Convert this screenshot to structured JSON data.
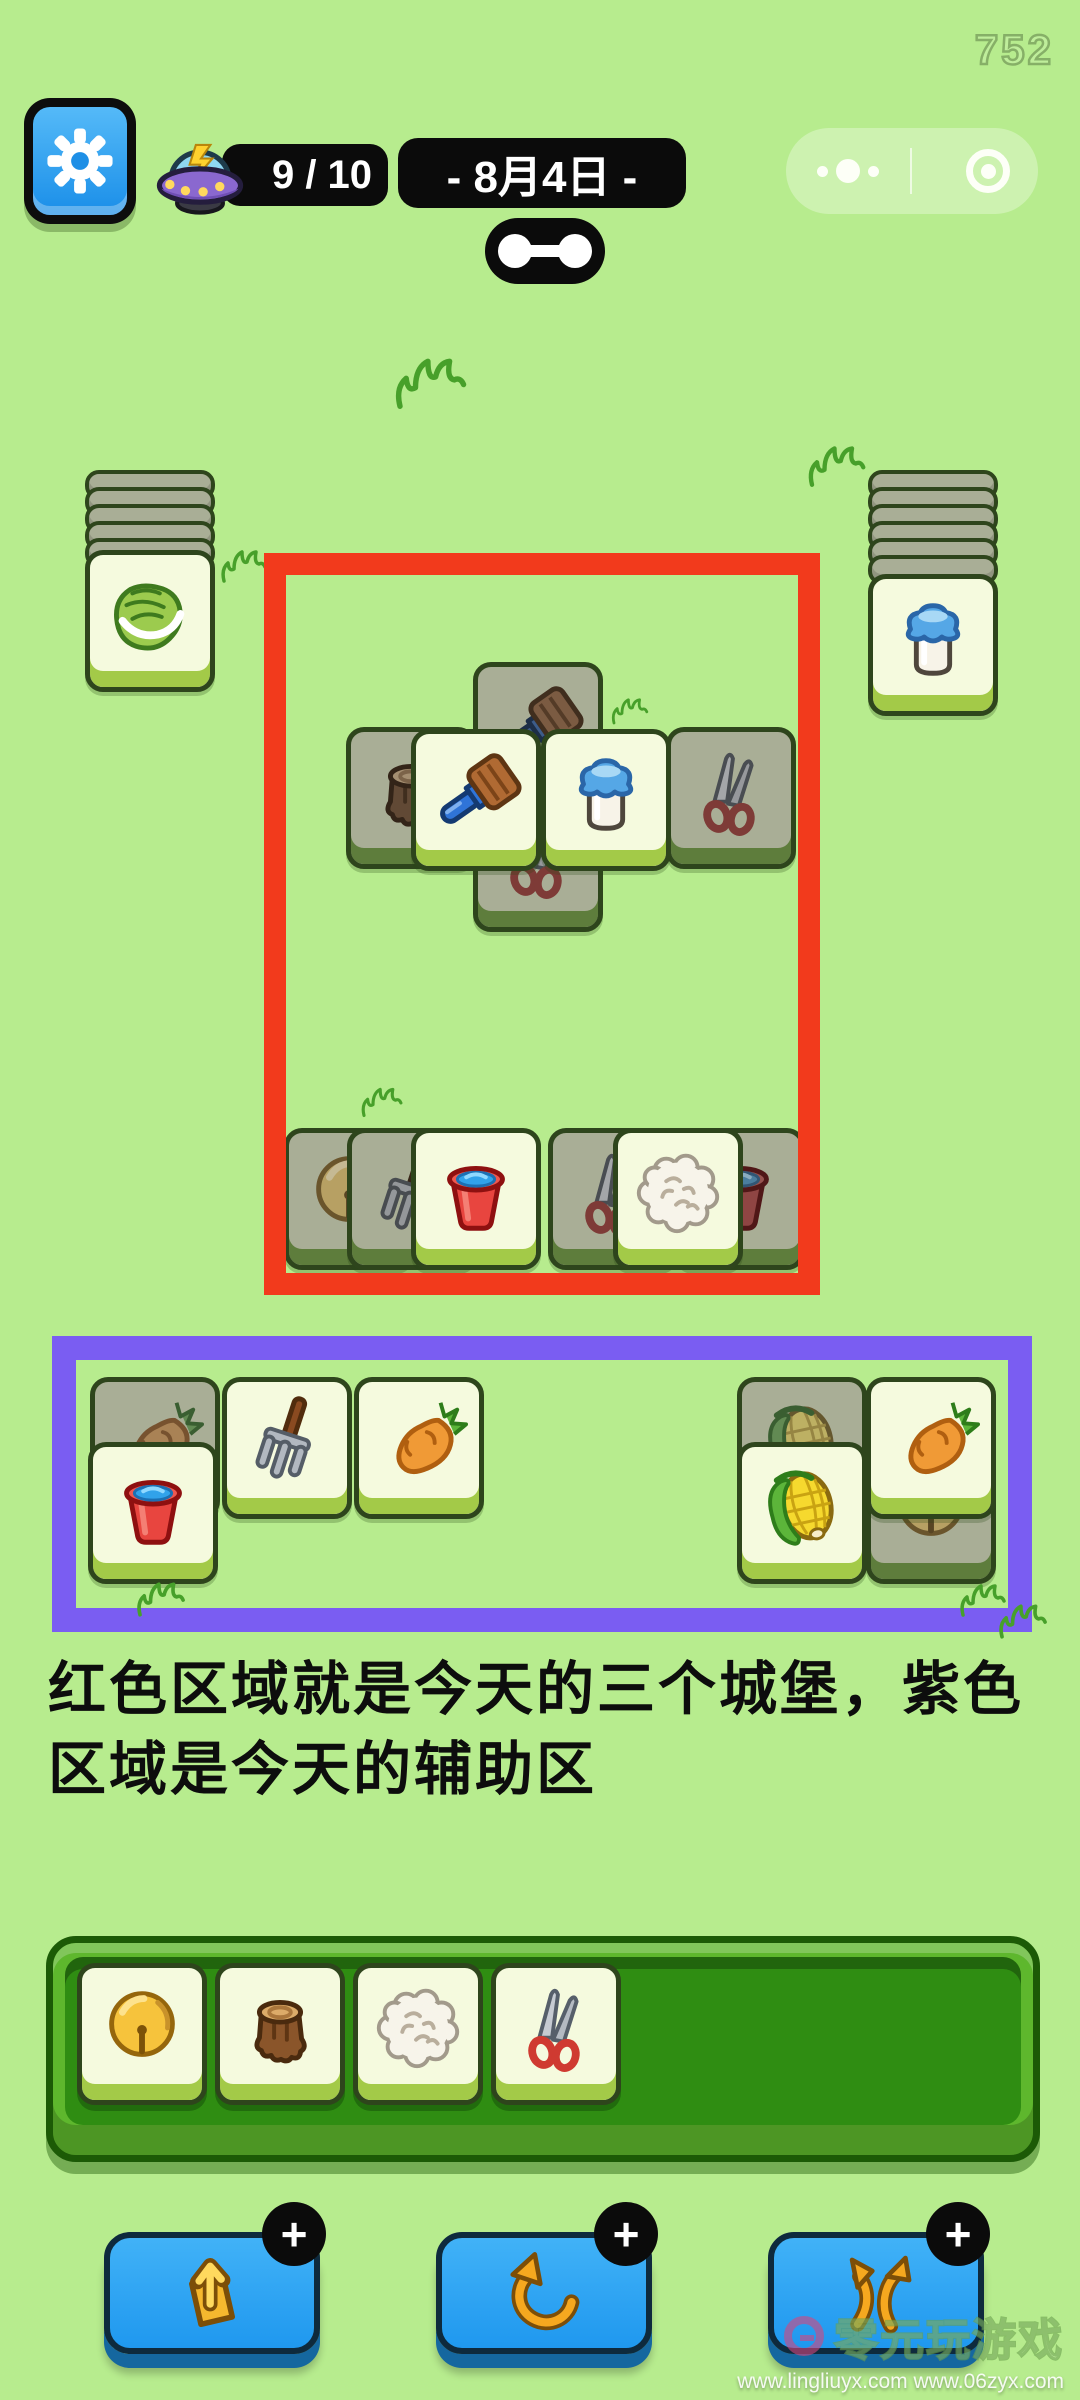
{
  "hud": {
    "score": "752",
    "energy_label": "9 / 10",
    "date_label": "- 8月4日 -",
    "capsule_more_icon": "more-dots-icon",
    "capsule_record_icon": "record-icon"
  },
  "caption": {
    "text": "红色区域就是今天的三个城堡，紫色\n区域是今天的辅助区"
  },
  "toolbar": {
    "buttons": [
      {
        "id": "remove",
        "icon": "pop-out-tile-icon",
        "badge": "+"
      },
      {
        "id": "undo",
        "icon": "undo-arrow-icon",
        "badge": "+"
      },
      {
        "id": "shuffle",
        "icon": "shuffle-arrows-icon",
        "badge": "+"
      }
    ]
  },
  "watermark": {
    "brand": "零元玩游戏",
    "urls": "www.lingliuyx.com    www.06zyx.com"
  },
  "colors": {
    "background": "#b7ec8e",
    "red_zone": "#f23a1c",
    "purple_zone": "#7a5df2",
    "pill_black": "#0b0b0b",
    "tile_face": "#f5fade",
    "tile_shaded": "#a9ae96",
    "tray_green": "#5eb72d",
    "button_blue": "#2aa3f4"
  },
  "board": {
    "zones": [
      {
        "name": "red-zone",
        "x": 264,
        "y": 553,
        "w": 556,
        "h": 742,
        "border": 22,
        "color_key": "red_zone"
      },
      {
        "name": "purple-zone",
        "x": 52,
        "y": 1336,
        "w": 980,
        "h": 296,
        "border": 24,
        "color_key": "purple_zone"
      }
    ],
    "stacks": [
      {
        "icon": "cabbage",
        "x": 85,
        "y": 470,
        "layers": 5,
        "face_y": 550
      },
      {
        "icon": "milk",
        "x": 868,
        "y": 470,
        "layers": 6,
        "face_y": 574
      }
    ],
    "tiles": [
      {
        "icon": "brush",
        "shaded": true,
        "x": 473,
        "y": 662,
        "z": 1
      },
      {
        "icon": "stump",
        "shaded": true,
        "x": 346,
        "y": 727,
        "z": 2
      },
      {
        "icon": "shears",
        "shaded": true,
        "x": 666,
        "y": 727,
        "z": 2
      },
      {
        "icon": "shears",
        "shaded": true,
        "x": 473,
        "y": 790,
        "z": 1
      },
      {
        "icon": "brush",
        "shaded": false,
        "x": 411,
        "y": 729,
        "z": 3
      },
      {
        "icon": "milk",
        "shaded": false,
        "x": 541,
        "y": 729,
        "z": 3
      },
      {
        "icon": "bell",
        "shaded": true,
        "x": 284,
        "y": 1128,
        "z": 1
      },
      {
        "icon": "fork",
        "shaded": true,
        "x": 347,
        "y": 1128,
        "z": 2
      },
      {
        "icon": "bucket",
        "shaded": false,
        "x": 411,
        "y": 1128,
        "z": 3
      },
      {
        "icon": "shears",
        "shaded": true,
        "x": 548,
        "y": 1128,
        "z": 1
      },
      {
        "icon": "bucket",
        "shaded": true,
        "x": 675,
        "y": 1128,
        "z": 1
      },
      {
        "icon": "wool",
        "shaded": false,
        "x": 613,
        "y": 1128,
        "z": 3
      },
      {
        "icon": "carrot",
        "shaded": true,
        "x": 90,
        "y": 1377,
        "z": 1
      },
      {
        "icon": "fork",
        "shaded": false,
        "x": 222,
        "y": 1377,
        "z": 2
      },
      {
        "icon": "carrot",
        "shaded": false,
        "x": 354,
        "y": 1377,
        "z": 2
      },
      {
        "icon": "bucket",
        "shaded": false,
        "x": 88,
        "y": 1442,
        "z": 3
      },
      {
        "icon": "corn",
        "shaded": true,
        "x": 737,
        "y": 1377,
        "z": 1
      },
      {
        "icon": "bell",
        "shaded": true,
        "x": 866,
        "y": 1442,
        "z": 1
      },
      {
        "icon": "corn",
        "shaded": false,
        "x": 737,
        "y": 1442,
        "z": 2
      },
      {
        "icon": "carrot",
        "shaded": false,
        "x": 866,
        "y": 1377,
        "z": 3
      }
    ],
    "tray_tiles": [
      "bell",
      "stump",
      "wool",
      "shears"
    ],
    "grass": [
      {
        "x": 392,
        "y": 352,
        "w": 78,
        "h": 62
      },
      {
        "x": 213,
        "y": 546,
        "w": 62,
        "h": 40
      },
      {
        "x": 800,
        "y": 441,
        "w": 74,
        "h": 50
      },
      {
        "x": 610,
        "y": 690,
        "w": 40,
        "h": 42
      },
      {
        "x": 350,
        "y": 1084,
        "w": 64,
        "h": 36
      },
      {
        "x": 126,
        "y": 1578,
        "w": 70,
        "h": 42,
        "top": true
      },
      {
        "x": 958,
        "y": 1574,
        "w": 50,
        "h": 52,
        "top": true
      },
      {
        "x": 986,
        "y": 1600,
        "w": 74,
        "h": 42,
        "top": true
      }
    ]
  }
}
